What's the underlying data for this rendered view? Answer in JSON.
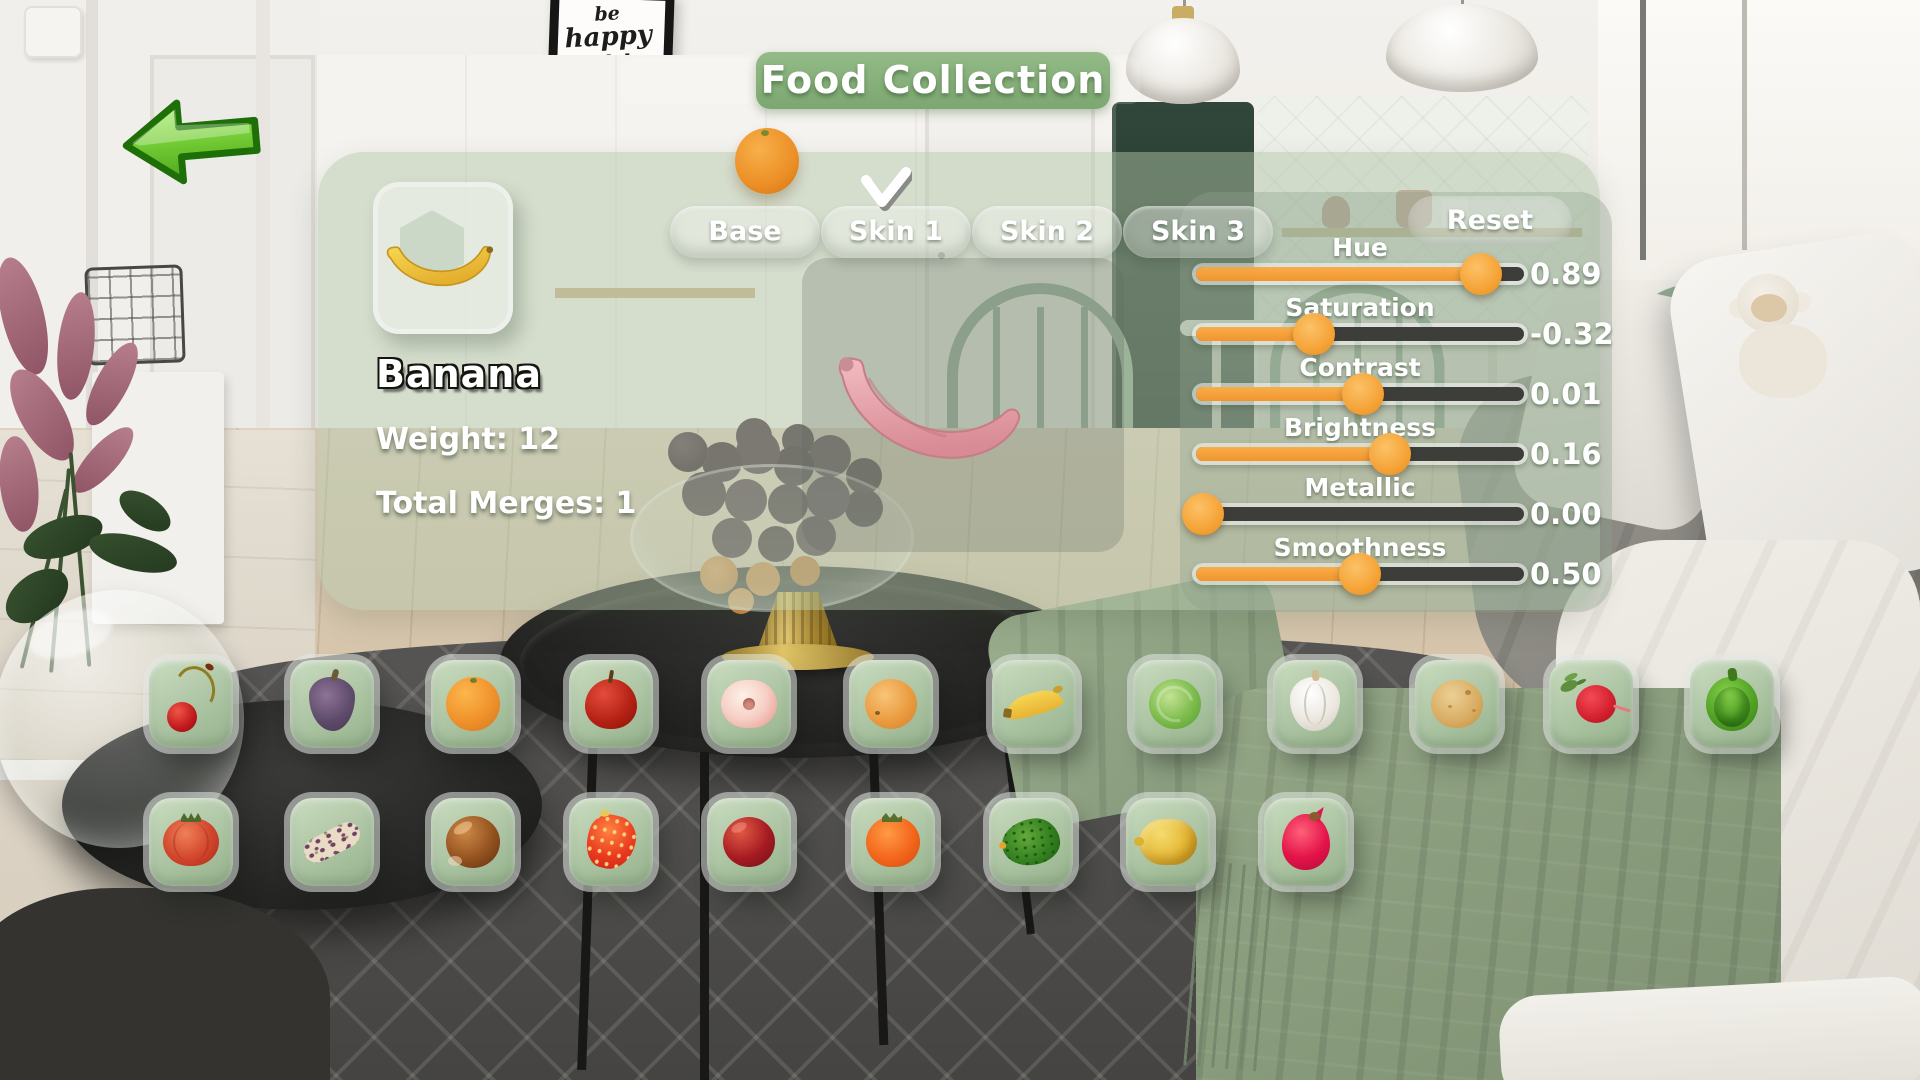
{
  "title": "Food Collection",
  "back_button": {
    "icon": "back-arrow-icon"
  },
  "item_panel": {
    "name": "Banana",
    "weight": "Weight: 12",
    "total_merges": "Total Merges: 1"
  },
  "skin_tabs": {
    "tabs": [
      {
        "label": "Base",
        "selected": false
      },
      {
        "label": "Skin 1",
        "selected": true
      },
      {
        "label": "Skin 2",
        "selected": false
      },
      {
        "label": "Skin 3",
        "selected": false
      }
    ],
    "reset_label": "Reset"
  },
  "material_sliders": [
    {
      "label": "Hue",
      "value": "0.89",
      "fill": 0.87
    },
    {
      "label": "Saturation",
      "value": "-0.32",
      "fill": 0.36
    },
    {
      "label": "Contrast",
      "value": "0.01",
      "fill": 0.51
    },
    {
      "label": "Brightness",
      "value": "0.16",
      "fill": 0.59
    },
    {
      "label": "Metallic",
      "value": "0.00",
      "fill": 0.02
    },
    {
      "label": "Smoothness",
      "value": "0.50",
      "fill": 0.5
    }
  ],
  "collection": {
    "row1": [
      "cherry",
      "fig",
      "orange",
      "apple",
      "flat-peach",
      "apricot",
      "banana",
      "brussels-sprout",
      "garlic",
      "potato",
      "radish",
      "green-pepper"
    ],
    "row2": [
      "tomato",
      "corn",
      "chestnut",
      "strawberry",
      "nectarine",
      "persimmon",
      "avocado",
      "citron",
      "dragonfruit"
    ]
  },
  "scene": {
    "poster_lines": [
      "be",
      "happy",
      "not to",
      "impress"
    ]
  },
  "colors": {
    "accent_orange": "#F5A23A",
    "banner_green": "#86B07A",
    "panel_tint": "#B1C5A7",
    "slider_track": "#3D3D3A",
    "tab_pill": "rgba(255,255,255,0.34)",
    "back_arrow_green": "#6FC832",
    "preview_pink": "#E8A7AF"
  }
}
